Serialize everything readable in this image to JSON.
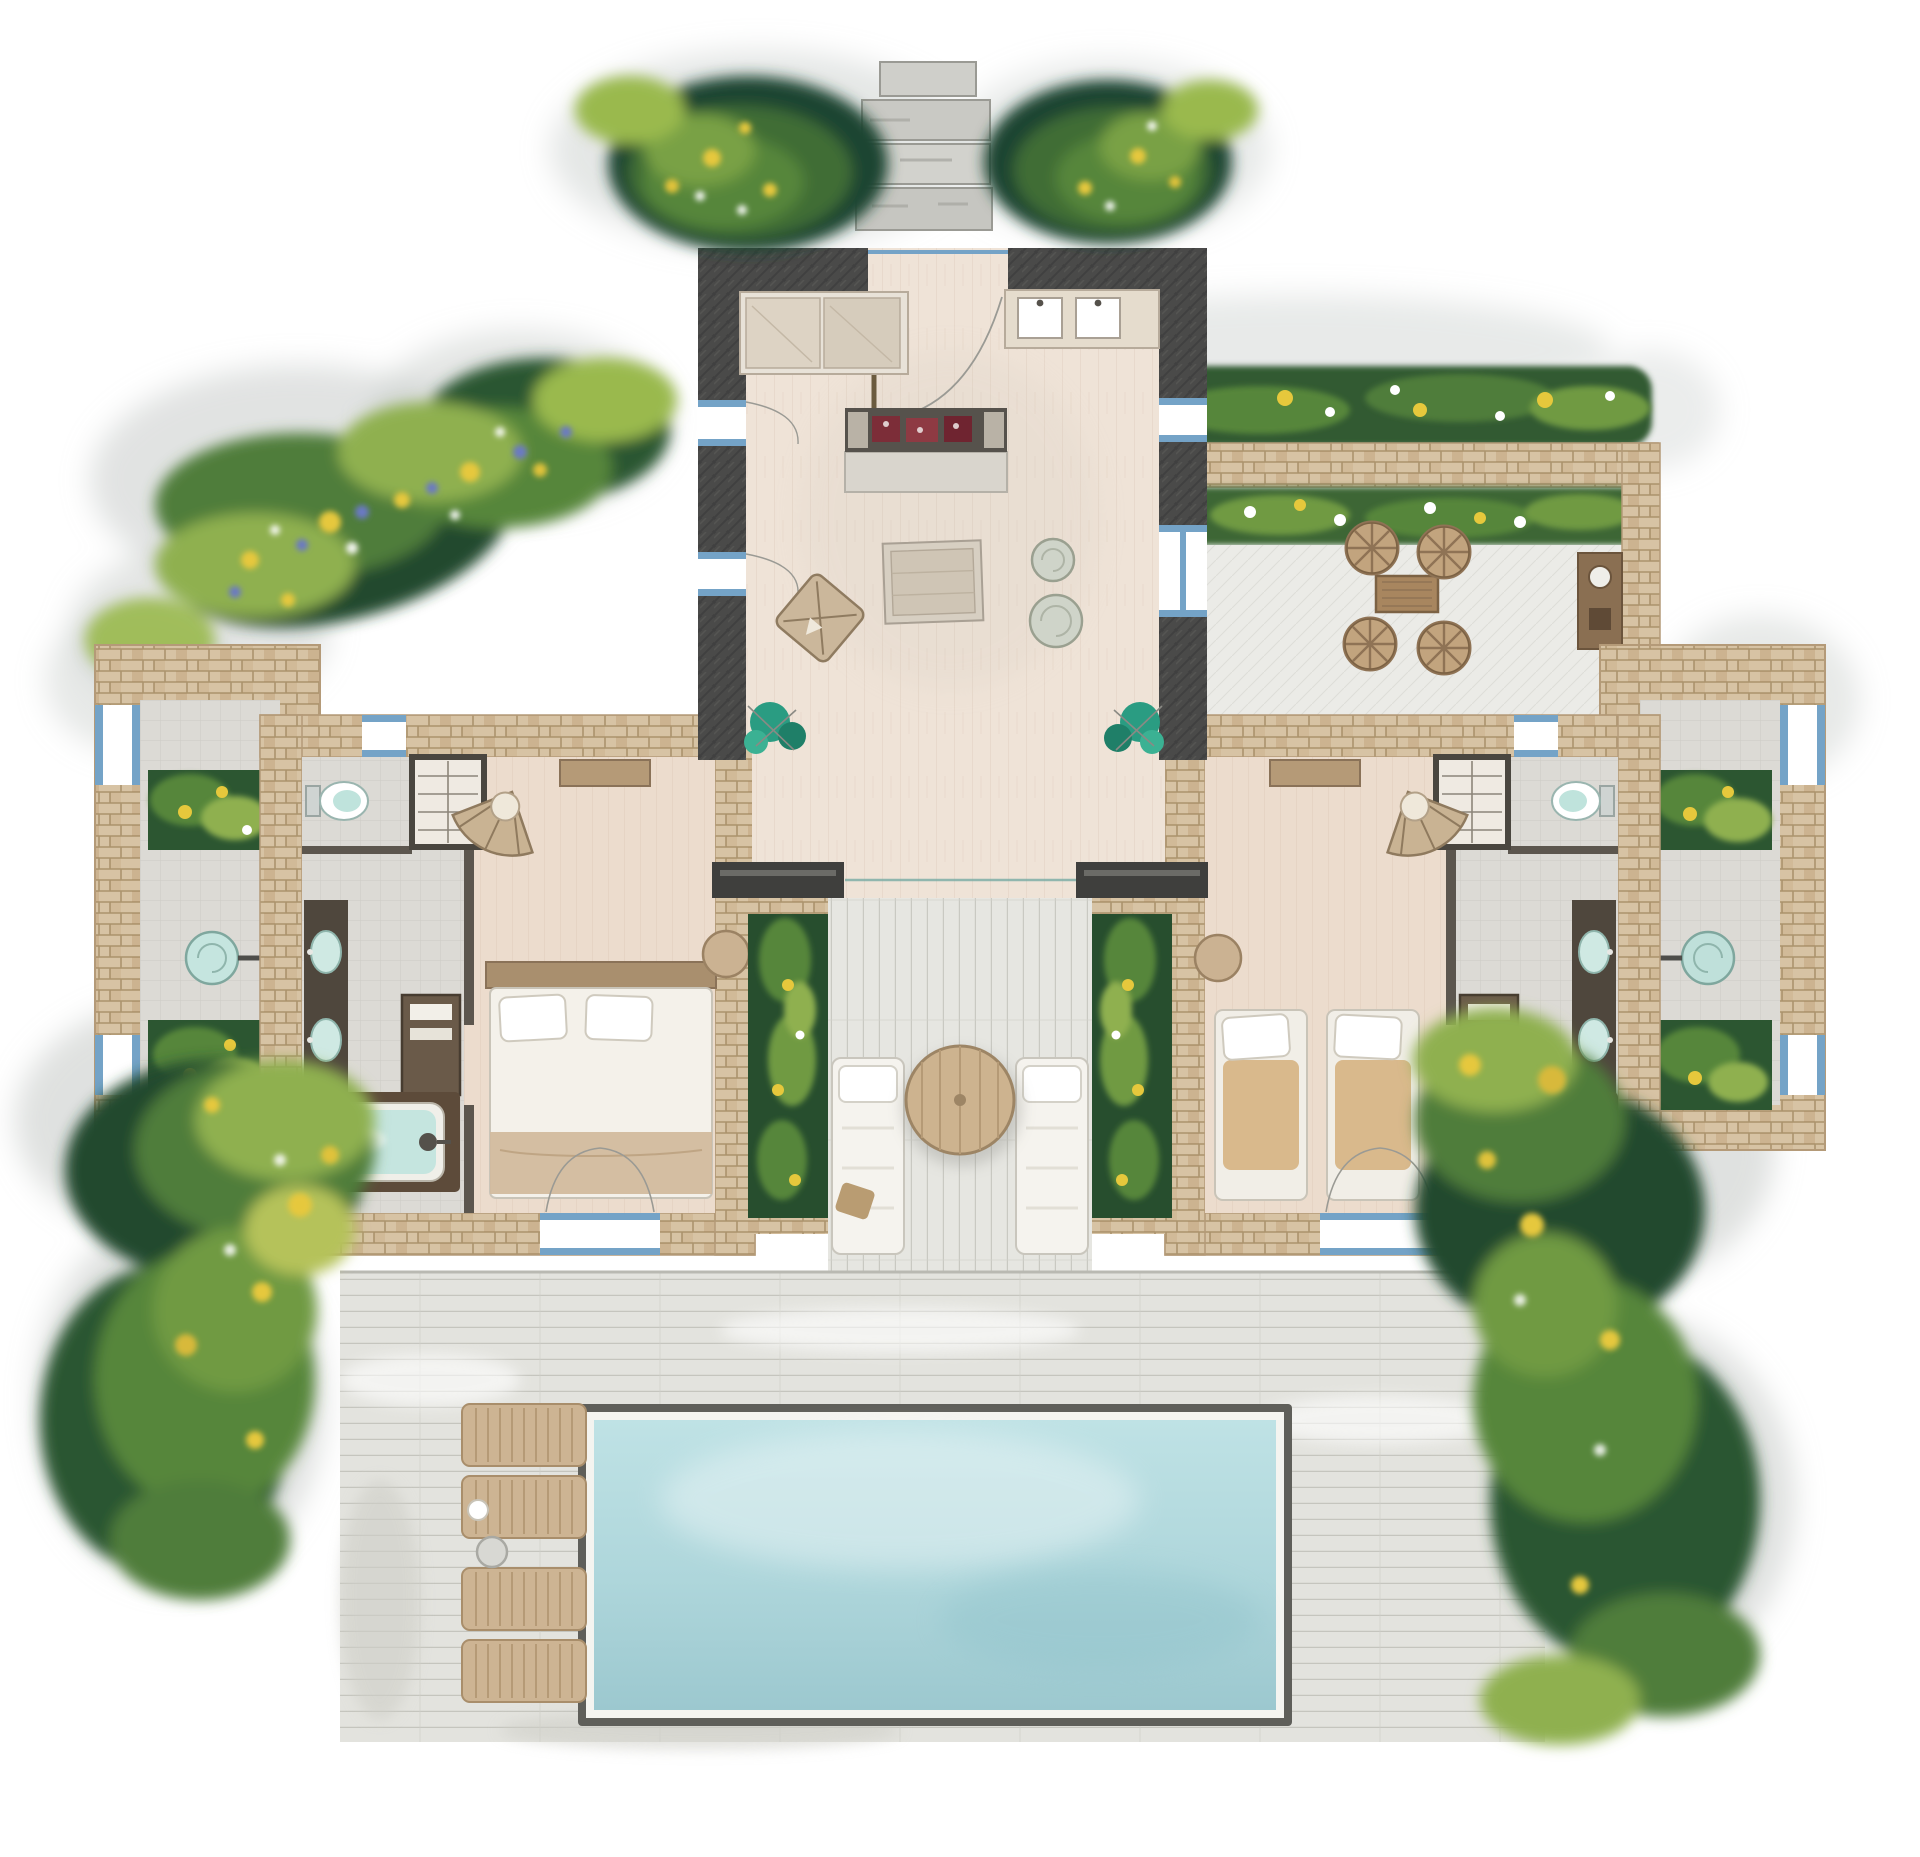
{
  "title": "Watercolor floor plan of a two-bedroom pool villa",
  "palette": {
    "background": "#ffffff",
    "wallCharcoal": "#4a4a49",
    "stoneWall": "#d7c3a4",
    "stoneJoint": "#a0875f",
    "interiorFloor": "#efe3d7",
    "bedroomFloor": "#ecdccd",
    "tileFloor": "#dcdad5",
    "deckWood": "#e3e3de",
    "deckLine": "#c5c5be",
    "courtyardDeck": "#e6e6e1",
    "terracePaving": "#ebebe7",
    "poolRim": "#5f5f5a",
    "poolCoping": "#f4f4f0",
    "poolWater": "#bfe2e5",
    "poolWaterDeep": "#9cc8cf",
    "bathWater": "#c5e5df",
    "tealPlant": "#2a9c82",
    "hedgeDark": "#274e2e",
    "hedgeMid": "#4f7d3a",
    "leafLight": "#8fb04f",
    "flowerYellow": "#e6c83c",
    "flowerBlue": "#6b79c5",
    "flowerWhite": "#ffffff",
    "furnitureWood": "#c7ae8d",
    "furnitureWicker": "#c2a47e",
    "linenWhite": "#f4f1ea",
    "cushionTan": "#d9b98c",
    "accentMaroon": "#7c2d38",
    "frameBlue": "#74a3c7",
    "grayWash": "#c3c7c5",
    "darkJoinery": "#4f473d"
  },
  "areas": {
    "entrance": {
      "name": "entrance steps",
      "steps": 4
    },
    "living_pavilion": {
      "name": "living pavilion",
      "furniture": [
        "sofa-bench",
        "kitchenette-counter",
        "decor-console",
        "covered-table",
        "armchair",
        "side-table",
        "side-table"
      ]
    },
    "terrace": {
      "name": "outdoor dining terrace",
      "dining_chairs": 4,
      "dining_tables": 1,
      "flower_beds": 2
    },
    "bedroom_left": {
      "name": "left bedroom",
      "furniture": [
        "bed",
        "wardrobe",
        "fan-chair",
        "desk",
        "pouf"
      ]
    },
    "bedroom_right": {
      "name": "right bedroom",
      "furniture": [
        "lounge-chair",
        "lounge-chair",
        "wardrobe",
        "fan-chair",
        "desk",
        "pouf"
      ]
    },
    "bathroom_left": {
      "name": "left bathroom",
      "fixtures": [
        "double-vanity",
        "bathtub",
        "toilet",
        "cabinet"
      ]
    },
    "bathroom_right": {
      "name": "right bathroom",
      "fixtures": [
        "double-vanity",
        "bathtub",
        "toilet",
        "cabinet"
      ]
    },
    "outdoor_shower_left": {
      "name": "left outdoor shower court",
      "planters": 2
    },
    "outdoor_shower_right": {
      "name": "right outdoor shower court",
      "planters": 2
    },
    "courtyard": {
      "name": "central courtyard",
      "daybeds": 2,
      "round_tables": 1,
      "planters": 2
    },
    "pool_deck": {
      "name": "sun deck",
      "loungers": 4,
      "side_tables": 1
    },
    "pool": {
      "name": "swimming pool"
    },
    "gardens": {
      "name": "surrounding gardens",
      "beds": 4
    }
  }
}
